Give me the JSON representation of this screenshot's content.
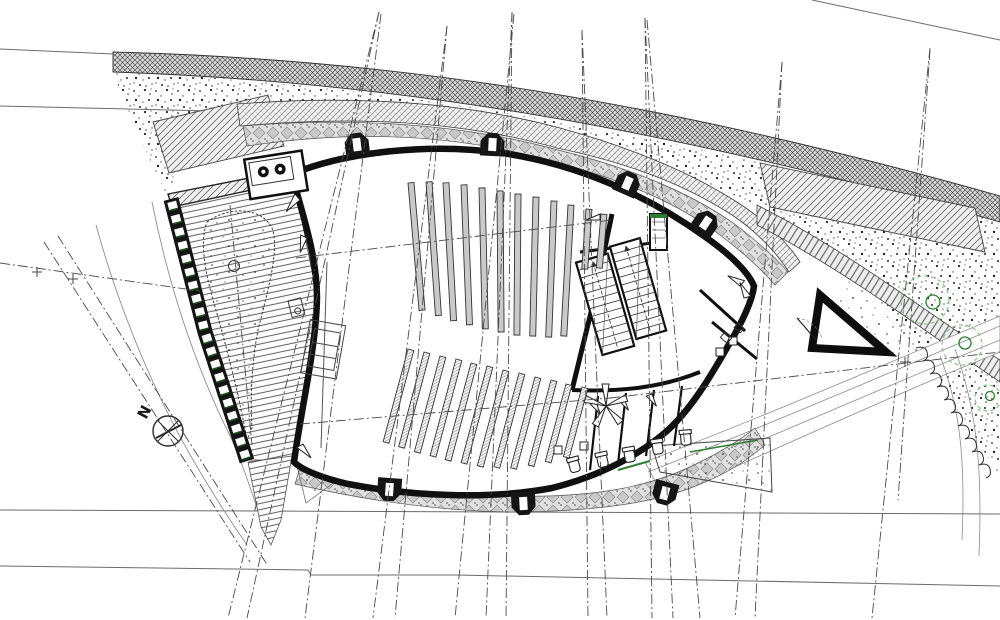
{
  "meta": {
    "drawing_type": "architectural site and floor plan",
    "subject": "curved lens-shaped hall (church/auditorium) with garden court, stairs, WC wing and site works"
  },
  "labels": {
    "north": "N"
  },
  "palette": {
    "ink": "#151515",
    "line_gray": "#555555",
    "light_gray": "#8a8a8a",
    "paper": "#ffffff",
    "green_dark": "#1e4b1e",
    "green": "#2e7d32",
    "green_light": "#8fbf8f"
  },
  "pews": {
    "upper_rows": [
      {
        "x": 408,
        "y": 183,
        "l": 128
      },
      {
        "x": 426,
        "y": 182,
        "l": 134
      },
      {
        "x": 443,
        "y": 183,
        "l": 138
      },
      {
        "x": 461,
        "y": 185,
        "l": 140
      },
      {
        "x": 479,
        "y": 188,
        "l": 141
      },
      {
        "x": 497,
        "y": 191,
        "l": 141
      },
      {
        "x": 515,
        "y": 194,
        "l": 141
      },
      {
        "x": 533,
        "y": 197,
        "l": 139
      },
      {
        "x": 551,
        "y": 201,
        "l": 136
      },
      {
        "x": 568,
        "y": 205,
        "l": 131
      },
      {
        "x": 586,
        "y": 209,
        "l": 60
      },
      {
        "x": 601,
        "y": 214,
        "l": 54
      }
    ],
    "lower_rows": [
      {
        "x": 408,
        "y": 349,
        "l": 96
      },
      {
        "x": 424,
        "y": 352,
        "l": 98
      },
      {
        "x": 440,
        "y": 356,
        "l": 99
      },
      {
        "x": 456,
        "y": 359,
        "l": 100
      },
      {
        "x": 471,
        "y": 363,
        "l": 100
      },
      {
        "x": 487,
        "y": 366,
        "l": 100
      },
      {
        "x": 503,
        "y": 370,
        "l": 99
      },
      {
        "x": 519,
        "y": 373,
        "l": 97
      },
      {
        "x": 535,
        "y": 377,
        "l": 94
      },
      {
        "x": 551,
        "y": 380,
        "l": 88
      },
      {
        "x": 566,
        "y": 384,
        "l": 80
      },
      {
        "x": 582,
        "y": 387,
        "l": 72
      }
    ]
  },
  "buttresses": [
    {
      "x": 358,
      "y": 153,
      "r": -7
    },
    {
      "x": 492,
      "y": 153,
      "r": 3
    },
    {
      "x": 624,
      "y": 191,
      "r": 24
    },
    {
      "x": 701,
      "y": 230,
      "r": 34
    },
    {
      "x": 390,
      "y": 481,
      "r": 184
    },
    {
      "x": 523,
      "y": 495,
      "r": 177
    },
    {
      "x": 667,
      "y": 485,
      "r": 195
    }
  ],
  "mast_guy_lines": [
    [
      379,
      12,
      228,
      618
    ],
    [
      379,
      12,
      247,
      618
    ],
    [
      381,
      14,
      305,
      618
    ],
    [
      447,
      26,
      373,
      618
    ],
    [
      447,
      26,
      395,
      618
    ],
    [
      512,
      12,
      486,
      618
    ],
    [
      512,
      12,
      506,
      618
    ],
    [
      514,
      14,
      455,
      618
    ],
    [
      582,
      30,
      588,
      618
    ],
    [
      582,
      30,
      607,
      618
    ],
    [
      645,
      18,
      652,
      618
    ],
    [
      645,
      18,
      673,
      618
    ],
    [
      647,
      20,
      700,
      618
    ],
    [
      782,
      62,
      735,
      618
    ],
    [
      782,
      62,
      755,
      618
    ],
    [
      930,
      48,
      872,
      618
    ],
    [
      930,
      50,
      898,
      500
    ],
    [
      44,
      242,
      250,
      562
    ],
    [
      58,
      236,
      268,
      566
    ],
    [
      0,
      263,
      200,
      291
    ],
    [
      610,
      398,
      1000,
      352
    ],
    [
      230,
      205,
      252,
      445
    ],
    [
      296,
      258,
      612,
      220
    ],
    [
      300,
      424,
      610,
      398
    ]
  ],
  "ladder_band_segments": [
    {
      "x1": 171,
      "y1": 199,
      "x2": 205,
      "y2": 332,
      "cells": 10
    },
    {
      "x1": 205,
      "y1": 332,
      "x2": 247,
      "y2": 461,
      "cells": 10
    }
  ],
  "stairs": {
    "flights": [
      {
        "x": 588,
        "y": 252,
        "w": 33,
        "h": 96,
        "steps": 12
      },
      {
        "x": 625,
        "y": 246,
        "w": 31,
        "h": 96,
        "steps": 12
      }
    ],
    "rotation": -16,
    "cx": 620,
    "cy": 300
  },
  "wc_fixtures": [
    {
      "x": 575,
      "y": 468,
      "r": -15
    },
    {
      "x": 603,
      "y": 463,
      "r": -12
    },
    {
      "x": 630,
      "y": 458,
      "r": -10
    },
    {
      "x": 658,
      "y": 450,
      "r": -8
    },
    {
      "x": 686,
      "y": 441,
      "r": -5
    }
  ],
  "sinks": [
    {
      "x": 558,
      "y": 450
    },
    {
      "x": 584,
      "y": 446
    },
    {
      "x": 720,
      "y": 352
    },
    {
      "x": 733,
      "y": 341
    }
  ],
  "trees": {
    "canopies": [
      [
        925,
        300,
        24
      ],
      [
        962,
        345,
        20
      ],
      [
        988,
        398,
        13
      ]
    ],
    "trunks": [
      [
        933,
        302,
        7
      ],
      [
        965,
        343,
        6
      ],
      [
        990,
        396,
        4.5
      ]
    ]
  },
  "survey_marks": [
    [
      37,
      272
    ],
    [
      73,
      279
    ],
    [
      905,
      362
    ]
  ]
}
